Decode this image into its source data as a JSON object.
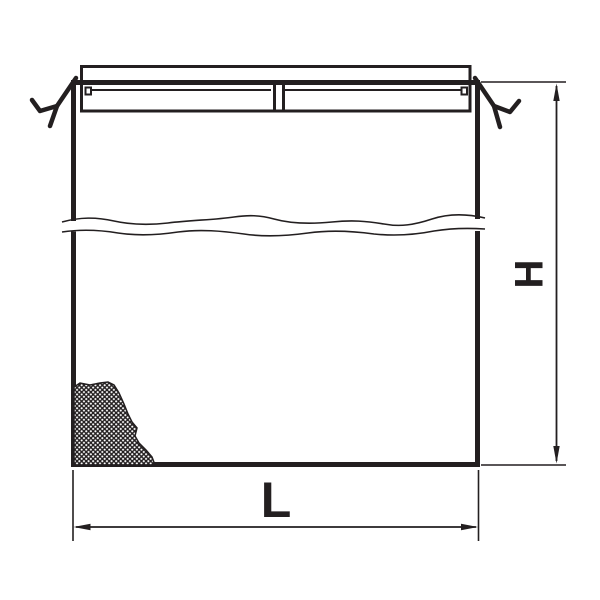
{
  "drawing": {
    "kind": "technical-line-drawing",
    "labels": {
      "height": "H",
      "length": "L"
    },
    "colors": {
      "ink": "#231f20",
      "background": "#ffffff"
    }
  }
}
